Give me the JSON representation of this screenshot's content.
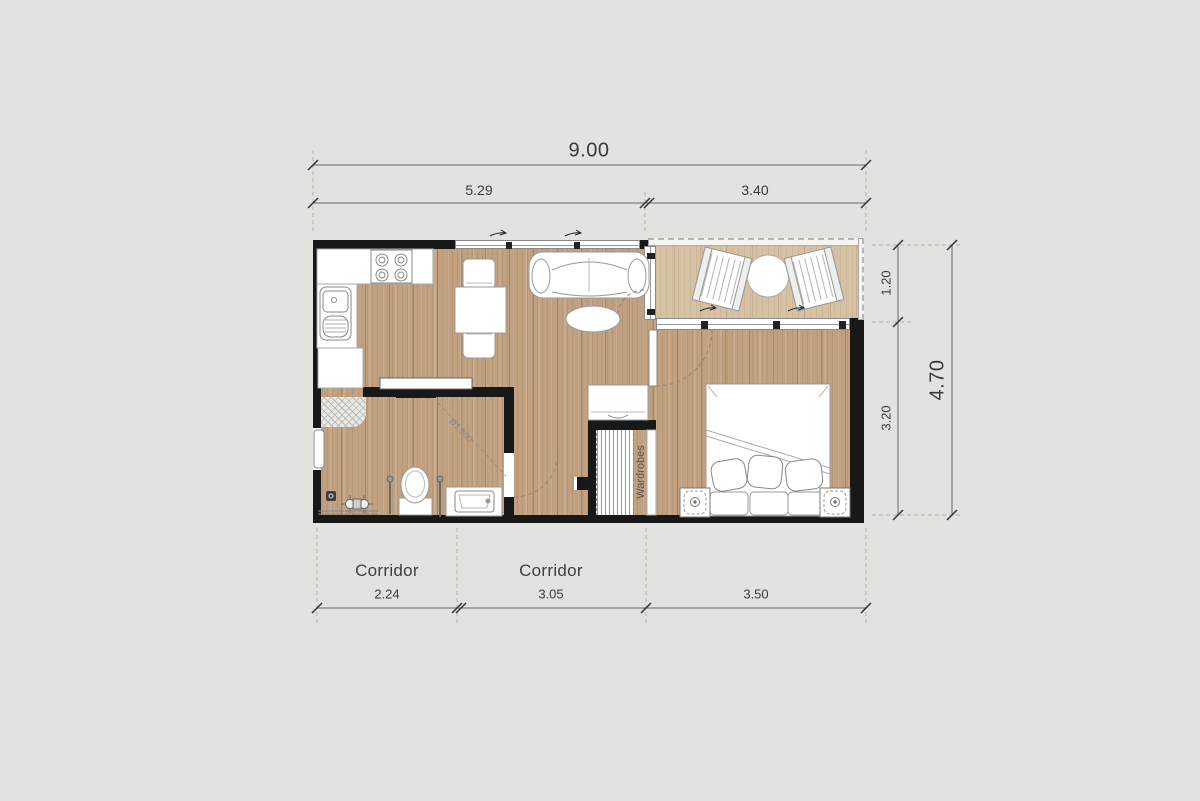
{
  "title": "Apartment floor plan",
  "dimensions": {
    "top_total": "9.00",
    "top_seg1": "5.29",
    "top_seg2": "3.40",
    "right_seg1": "1.20",
    "right_seg2": "3.20",
    "right_total": "4.70",
    "bottom_seg1": "2.24",
    "bottom_seg2": "3.05",
    "bottom_seg3": "3.50"
  },
  "labels": {
    "corridor1": "Corridor",
    "corridor2": "Corridor",
    "wardrobes": "Wardrobes",
    "turning_circle": "Ø1.500"
  },
  "colors": {
    "background": "#e2e3de",
    "wall": "#181818",
    "floor_wood": "#c2a181",
    "terrace_wood": "#d6c2a3",
    "dimension_text": "#3a3a3a"
  }
}
